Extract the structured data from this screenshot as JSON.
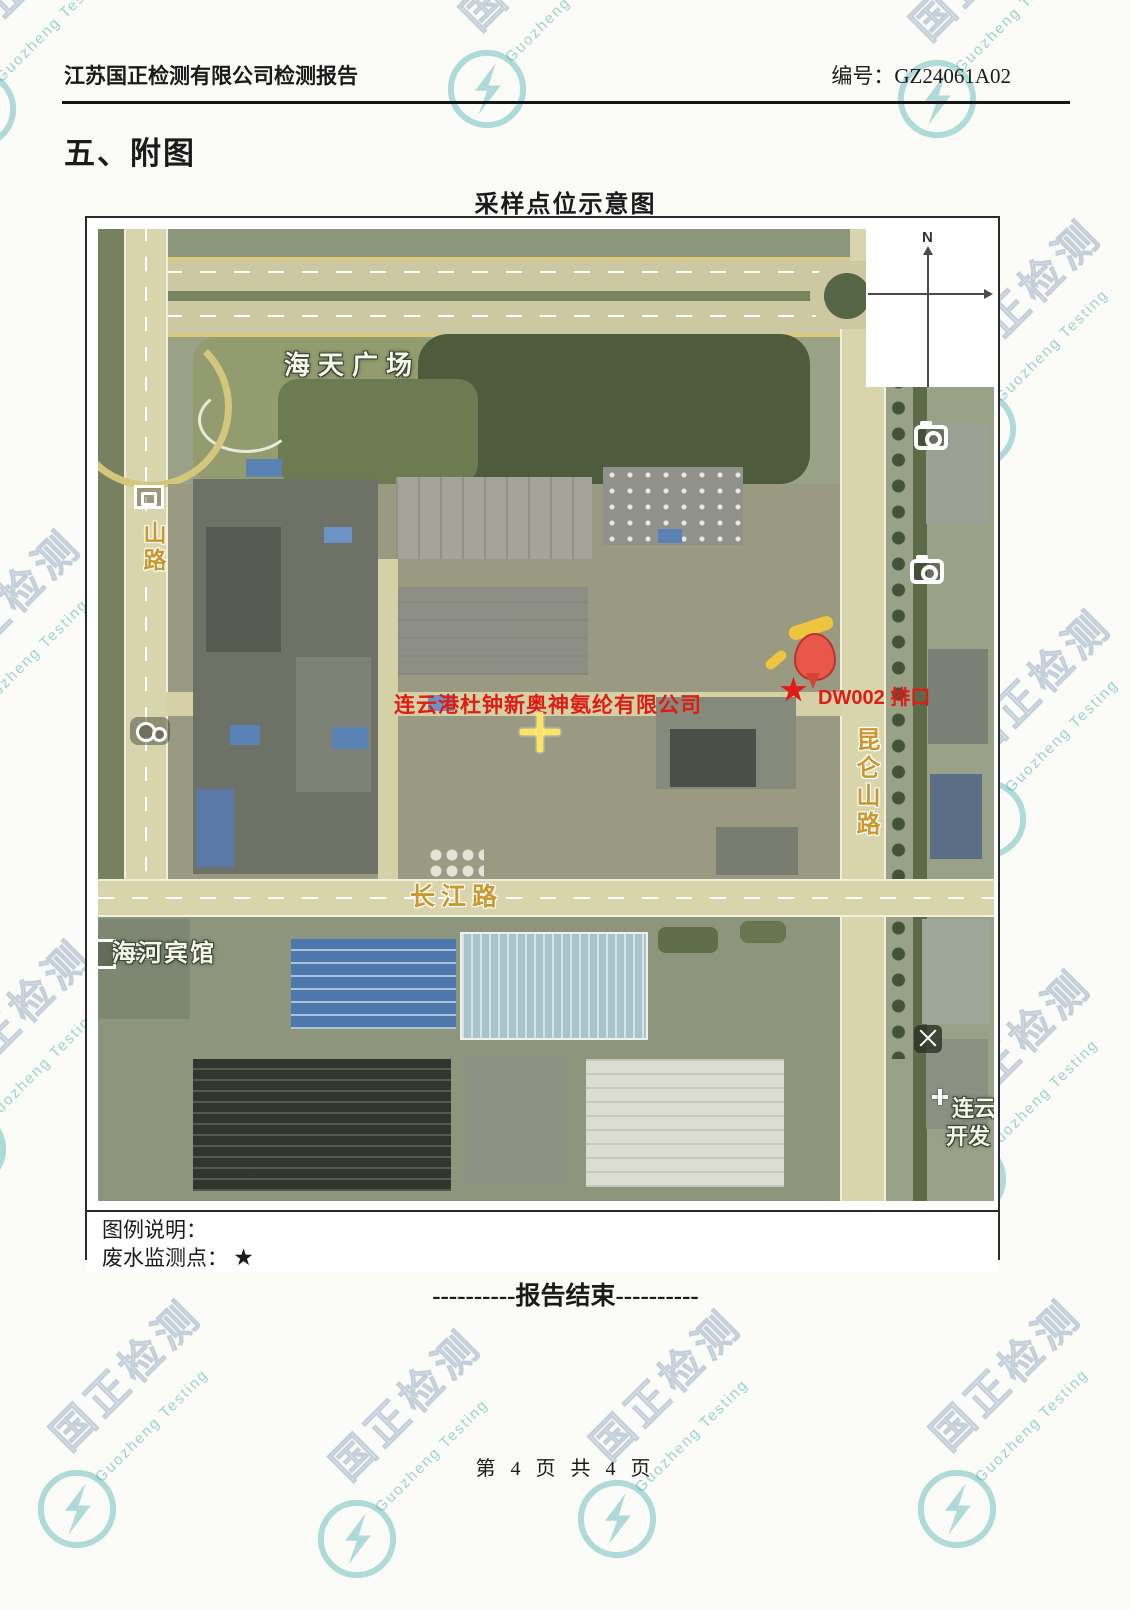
{
  "watermark": {
    "cn": "国正检测",
    "en": "Guozheng Testing"
  },
  "header": {
    "title": "江苏国正检测有限公司检测报告",
    "report_no": "编号：GZ24061A02"
  },
  "section_title": "五、附图",
  "figure": {
    "title": "采样点位示意图",
    "compass_north": "N",
    "map_labels": {
      "plaza": "海天广场",
      "left_road": "山路",
      "company": "连云港杜钟新奥神氨纶有限公司",
      "outfall_star": "★",
      "outfall": "DW002 排口",
      "kunlun_road": "昆仑山路",
      "changjiang_road": "长江路",
      "hotel": "海河宾馆",
      "dev_zone_line1": "连云",
      "dev_zone_line2": "开发"
    },
    "legend": {
      "heading": "图例说明：",
      "wastewater_label": "废水监测点：",
      "wastewater_symbol": "★"
    }
  },
  "end_marker": "----------报告结束----------",
  "footer": {
    "page_text": "第 4 页 共 4 页"
  }
}
